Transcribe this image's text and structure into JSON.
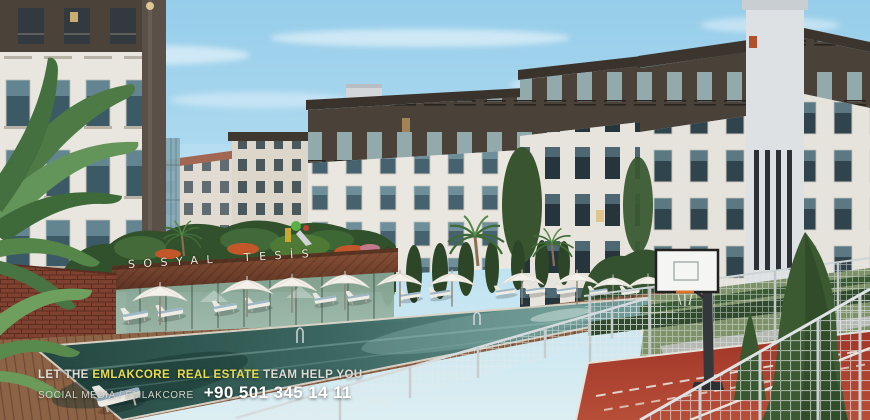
{
  "signage": {
    "social_facility": "SOSYAL TESİS"
  },
  "ad_overlay": {
    "line1_prefix": "LET THE ",
    "line1_brand": "EMLAKCORE  REAL ESTATE",
    "line1_suffix": " TEAM HELP YOU",
    "line2_social": "SOCIAL MEDIA / EMLAKCORE",
    "line2_phone": "+90 501 345 14 11"
  },
  "colors": {
    "brand_yellow": "#e6dc4e",
    "overlay_text": "#dddbd4",
    "phone_text": "#ffffff",
    "sign_band_brown": "#7c4a33",
    "pool_water_teal": "#3f6f6b",
    "court_red": "#a83a2c",
    "sky_blue": "#a5d4ec",
    "facade_white": "#e9e6df",
    "facade_dark_stone": "#4a4238"
  }
}
